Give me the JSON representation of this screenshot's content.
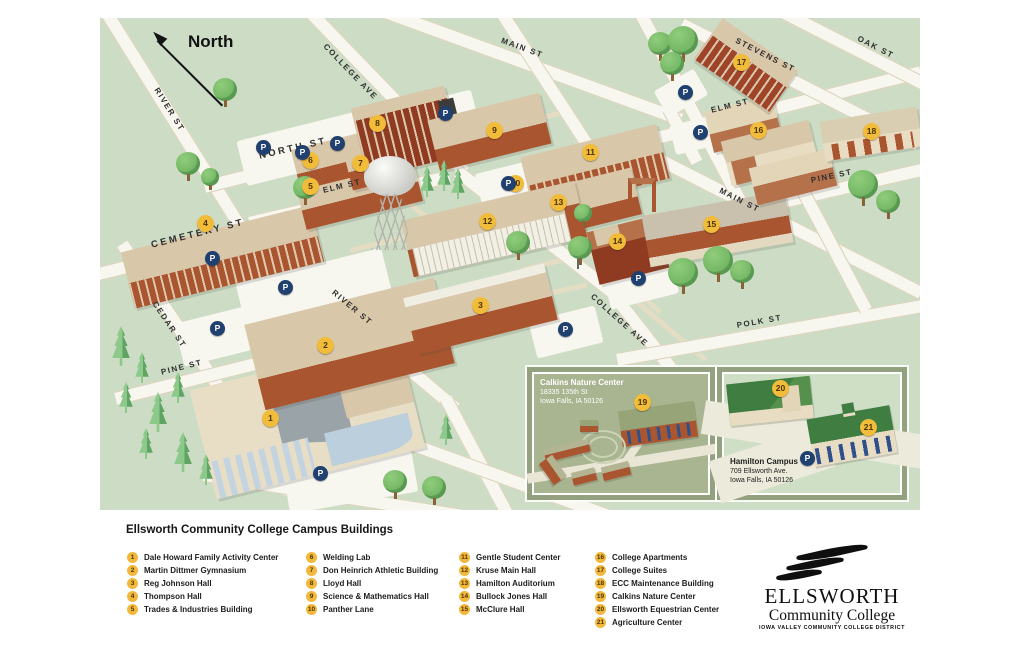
{
  "map": {
    "north_label": "North",
    "parking_symbol": "P",
    "streets": {
      "river": "RIVER ST",
      "cedar": "CEDAR ST",
      "college": "COLLEGE AVE",
      "main": "MAIN ST",
      "north": "NORTH ST",
      "elm": "ELM ST",
      "cemetery": "CEMETERY ST",
      "pine": "PINE ST",
      "polk": "POLK ST",
      "stevens": "STEVENS ST",
      "oak": "OAK ST"
    },
    "insets": {
      "calkins": {
        "title": "Calkins Nature Center",
        "address1": "18335 135th St",
        "address2": "Iowa Falls, IA 50126"
      },
      "hamilton": {
        "title": "Hamilton Campus",
        "address1": "709 Ellsworth Ave.",
        "address2": "Iowa Falls, IA 50126"
      }
    }
  },
  "legend": {
    "title": "Ellsworth Community College Campus Buildings"
  },
  "buildings": [
    {
      "num": "1",
      "label": "Dale Howard Family Activity Center"
    },
    {
      "num": "2",
      "label": "Martin Dittmer Gymnasium"
    },
    {
      "num": "3",
      "label": "Reg Johnson Hall"
    },
    {
      "num": "4",
      "label": "Thompson Hall"
    },
    {
      "num": "5",
      "label": "Trades & Industries Building"
    },
    {
      "num": "6",
      "label": "Welding Lab"
    },
    {
      "num": "7",
      "label": "Don Heinrich Athletic Building"
    },
    {
      "num": "8",
      "label": "Lloyd Hall"
    },
    {
      "num": "9",
      "label": "Science & Mathematics Hall"
    },
    {
      "num": "10",
      "label": "Panther Lane"
    },
    {
      "num": "11",
      "label": "Gentle Student Center"
    },
    {
      "num": "12",
      "label": "Kruse Main Hall"
    },
    {
      "num": "13",
      "label": "Hamilton Auditorium"
    },
    {
      "num": "14",
      "label": "Bullock Jones Hall"
    },
    {
      "num": "15",
      "label": "McClure Hall"
    },
    {
      "num": "16",
      "label": "College Apartments"
    },
    {
      "num": "17",
      "label": "College Suites"
    },
    {
      "num": "18",
      "label": "ECC Maintenance Building"
    },
    {
      "num": "19",
      "label": "Calkins Nature Center"
    },
    {
      "num": "20",
      "label": "Ellsworth Equestrian Center"
    },
    {
      "num": "21",
      "label": "Agriculture Center"
    }
  ],
  "logo": {
    "name": "ELLSWORTH",
    "type": "Community College",
    "district": "IOWA VALLEY COMMUNITY COLLEGE DISTRICT"
  },
  "colors": {
    "map_green": "#cdddc5",
    "street_white": "#f7f6ef",
    "roof_tan": "#d9c7a9",
    "brick_red": "#a9552f",
    "marker_yellow": "#f2bc3b",
    "parking_navy": "#20406f",
    "inset_frame": "#93a17f"
  }
}
